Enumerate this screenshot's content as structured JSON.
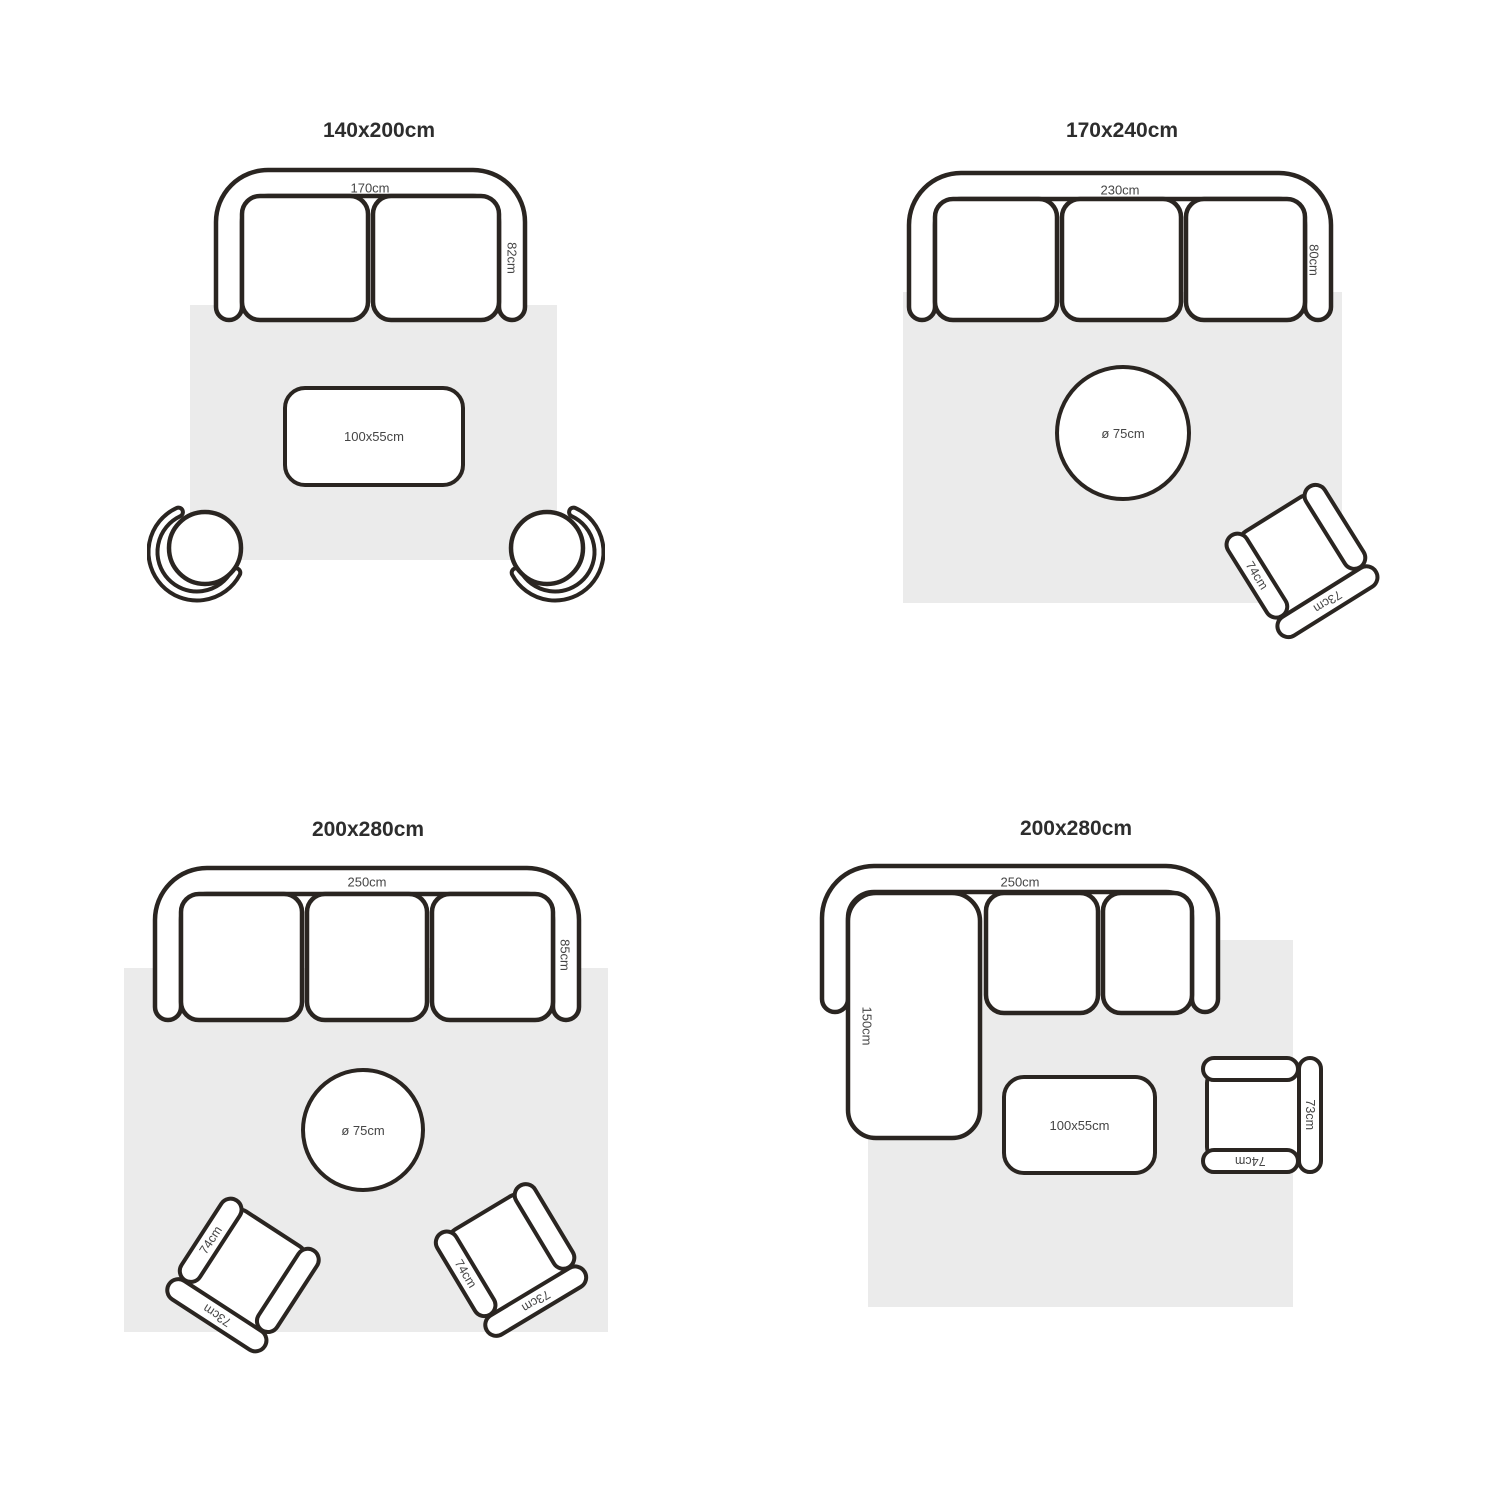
{
  "colors": {
    "outline": "#2a2521",
    "rug": "#ebebeb",
    "title": "#2d2d2d",
    "label": "#454545",
    "background": "#ffffff"
  },
  "layouts": {
    "top_left": {
      "title": "140x200cm",
      "sofa_width": "170cm",
      "sofa_depth": "82cm",
      "coffee_table": "100x55cm"
    },
    "top_right": {
      "title": "170x240cm",
      "sofa_width": "230cm",
      "sofa_depth": "80cm",
      "round_table": "ø 75cm",
      "armchair": {
        "arm": "74cm",
        "back": "73cm"
      }
    },
    "bottom_left": {
      "title": "200x280cm",
      "sofa_width": "250cm",
      "sofa_depth": "85cm",
      "round_table": "ø 75cm",
      "armchair_left": {
        "arm": "74cm",
        "back": "73cm"
      },
      "armchair_right": {
        "arm": "74cm",
        "back": "73cm"
      }
    },
    "bottom_right": {
      "title": "200x280cm",
      "sofa_width": "250cm",
      "chaise_depth": "150cm",
      "coffee_table": "100x55cm",
      "armchair": {
        "arm": "74cm",
        "back": "73cm"
      }
    }
  }
}
